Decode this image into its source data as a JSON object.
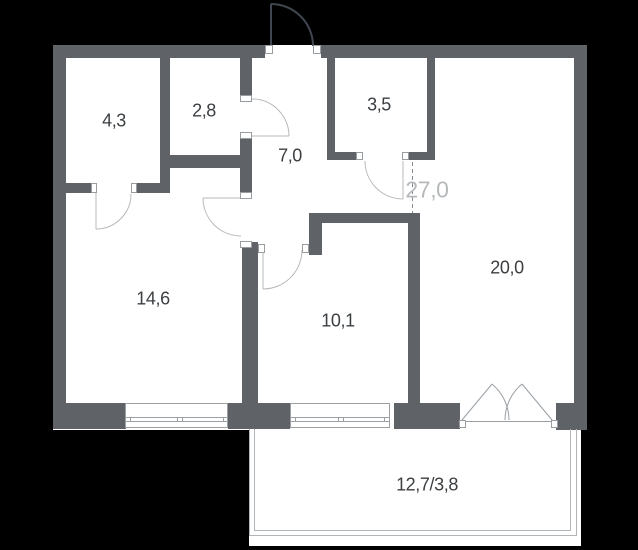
{
  "plan": {
    "type": "apartment-floor-plan",
    "rooms": [
      {
        "id": "room-top-left",
        "area": "4,3"
      },
      {
        "id": "room-top-mid",
        "area": "2,8"
      },
      {
        "id": "hallway",
        "area": "7,0"
      },
      {
        "id": "room-top-right-small",
        "area": "3,5"
      },
      {
        "id": "room-bottom-left",
        "area": "14,6"
      },
      {
        "id": "room-bottom-mid",
        "area": "10,1"
      },
      {
        "id": "living-area",
        "area": "20,0"
      }
    ],
    "combined_area_label": "27,0",
    "balcony_label": "12,7/3,8"
  },
  "colors": {
    "background": "#000000",
    "interior": "#ffffff",
    "wall": "#5f6367",
    "line": "#9aa0a4",
    "door_arc": "#b5b9bb",
    "balcony_line": "#b2b5b7",
    "dashed_line": "#858b8f",
    "entry_door": "#414750",
    "jamb_border": "#979da1",
    "text": "#3b3f42",
    "total_text": "#b6b9bb"
  }
}
